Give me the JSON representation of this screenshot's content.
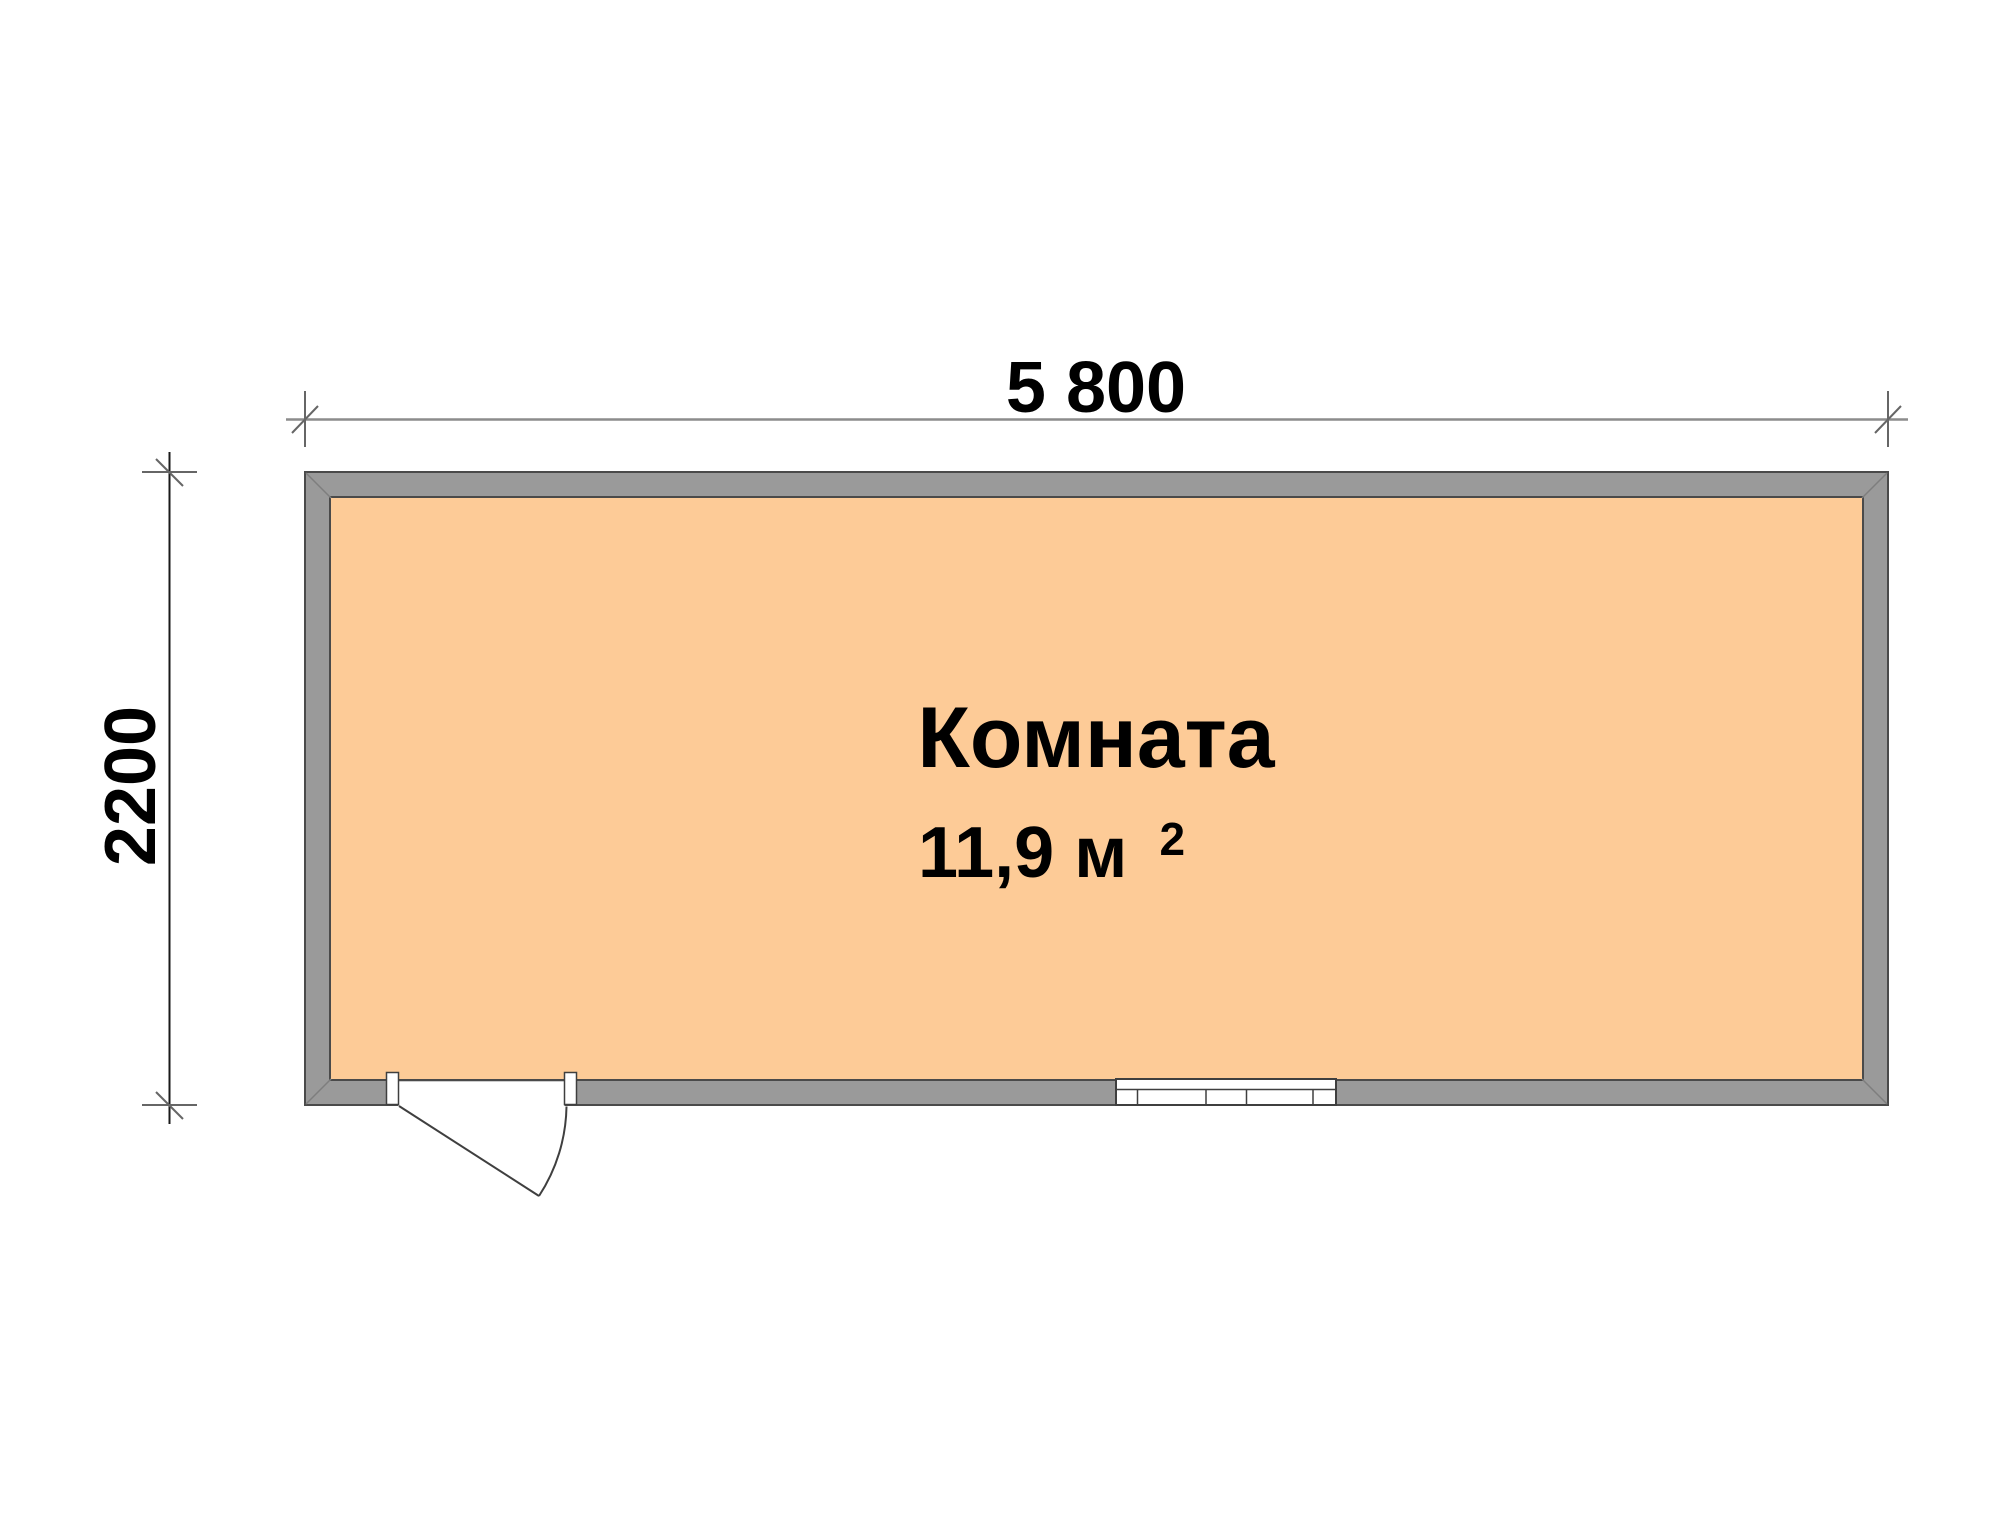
{
  "plan": {
    "room": {
      "name": "Комната",
      "area_main": "11,9 м",
      "area_sup": "2",
      "area_full": "11,9 м²"
    },
    "dimensions": {
      "width": "5 800",
      "height": "2200"
    },
    "features": {
      "door": "door",
      "window": "window"
    },
    "colors": {
      "background": "#FFFFFF",
      "floor": "#FDCB97",
      "wall_fill": "#9A9A9A",
      "wall_outline": "#4A4A4A",
      "miter": "#7E7E7E",
      "dim_line_horizontal": "#8C8C8C",
      "dim_line_vertical": "#1A1A1A",
      "dim_tick": "#666666",
      "feature_outline": "#3F3F3F",
      "text": "#000000"
    }
  }
}
